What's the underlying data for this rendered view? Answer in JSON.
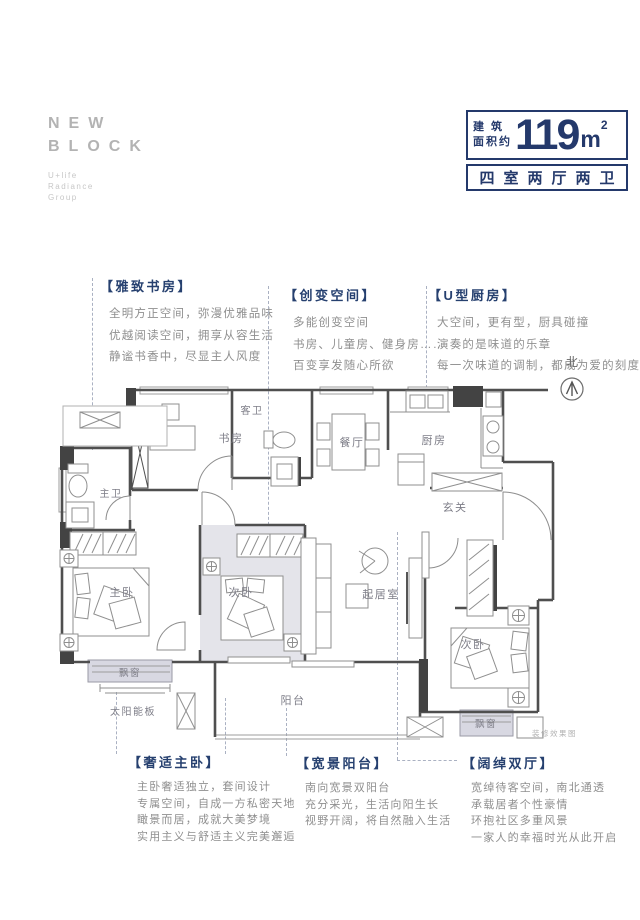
{
  "logo": {
    "line1": "NEW",
    "line2": "BLOCK",
    "sub_lines": [
      "U+life",
      "Radiance",
      "Group"
    ]
  },
  "badge": {
    "area_prefix_line1": "建 筑",
    "area_prefix_line2": "面积约",
    "area_value": "119",
    "area_unit": "m",
    "area_exponent": "2",
    "layout_text": "四室两厅两卫"
  },
  "compass": {
    "label": "北"
  },
  "annotations": {
    "study": {
      "title": "【雅致书房】",
      "lines": [
        "全明方正空间，弥漫优雅品味",
        "优越阅读空间，拥享从容生活",
        "静谧书香中，尽显主人风度"
      ]
    },
    "flex": {
      "title": "【创变空间】",
      "lines": [
        "多能创变空间",
        "书房、儿童房、健身房……",
        "百变享发随心所欲"
      ]
    },
    "kitchen": {
      "title": "【U型厨房】",
      "lines": [
        "大空间，更有型，厨具碰撞",
        "演奏的是味道的乐章",
        "每一次味道的调制，都成为爱的刻度"
      ]
    },
    "master": {
      "title": "【奢适主卧】",
      "lines": [
        "主卧奢适独立，套间设计",
        "专属空间，自成一方私密天地",
        "瞰景而居，成就大美梦境",
        "实用主义与舒适主义完美邂逅"
      ]
    },
    "balcony": {
      "title": "【宽景阳台】",
      "lines": [
        "南向宽景双阳台",
        "充分采光，生活向阳生长",
        "视野开阔，将自然融入生活"
      ]
    },
    "halls": {
      "title": "【阔绰双厅】",
      "lines": [
        "宽绰待客空间，南北通透",
        "承载居者个性豪情",
        "环抱社区多重风景",
        "一家人的幸福时光从此开启"
      ]
    }
  },
  "floorplan": {
    "labels": {
      "study": "书房",
      "guest_bath": "客卫",
      "dining": "餐厅",
      "kitchen": "厨房",
      "foyer": "玄关",
      "master_bath": "主卫",
      "master_bed": "主卧",
      "second_bed_mid": "次卧",
      "living": "起居室",
      "second_bed_right": "次卧",
      "bay_window_left": "飘窗",
      "bay_window_right": "飘窗",
      "solar_panel": "太阳能板",
      "balcony": "阳台"
    },
    "note": "装修效果图"
  },
  "colors": {
    "navy": "#24396b",
    "wall": "#4f4f4f",
    "bay_fill": "#d8d8e2",
    "room_highlight": "#e4e4ea"
  }
}
